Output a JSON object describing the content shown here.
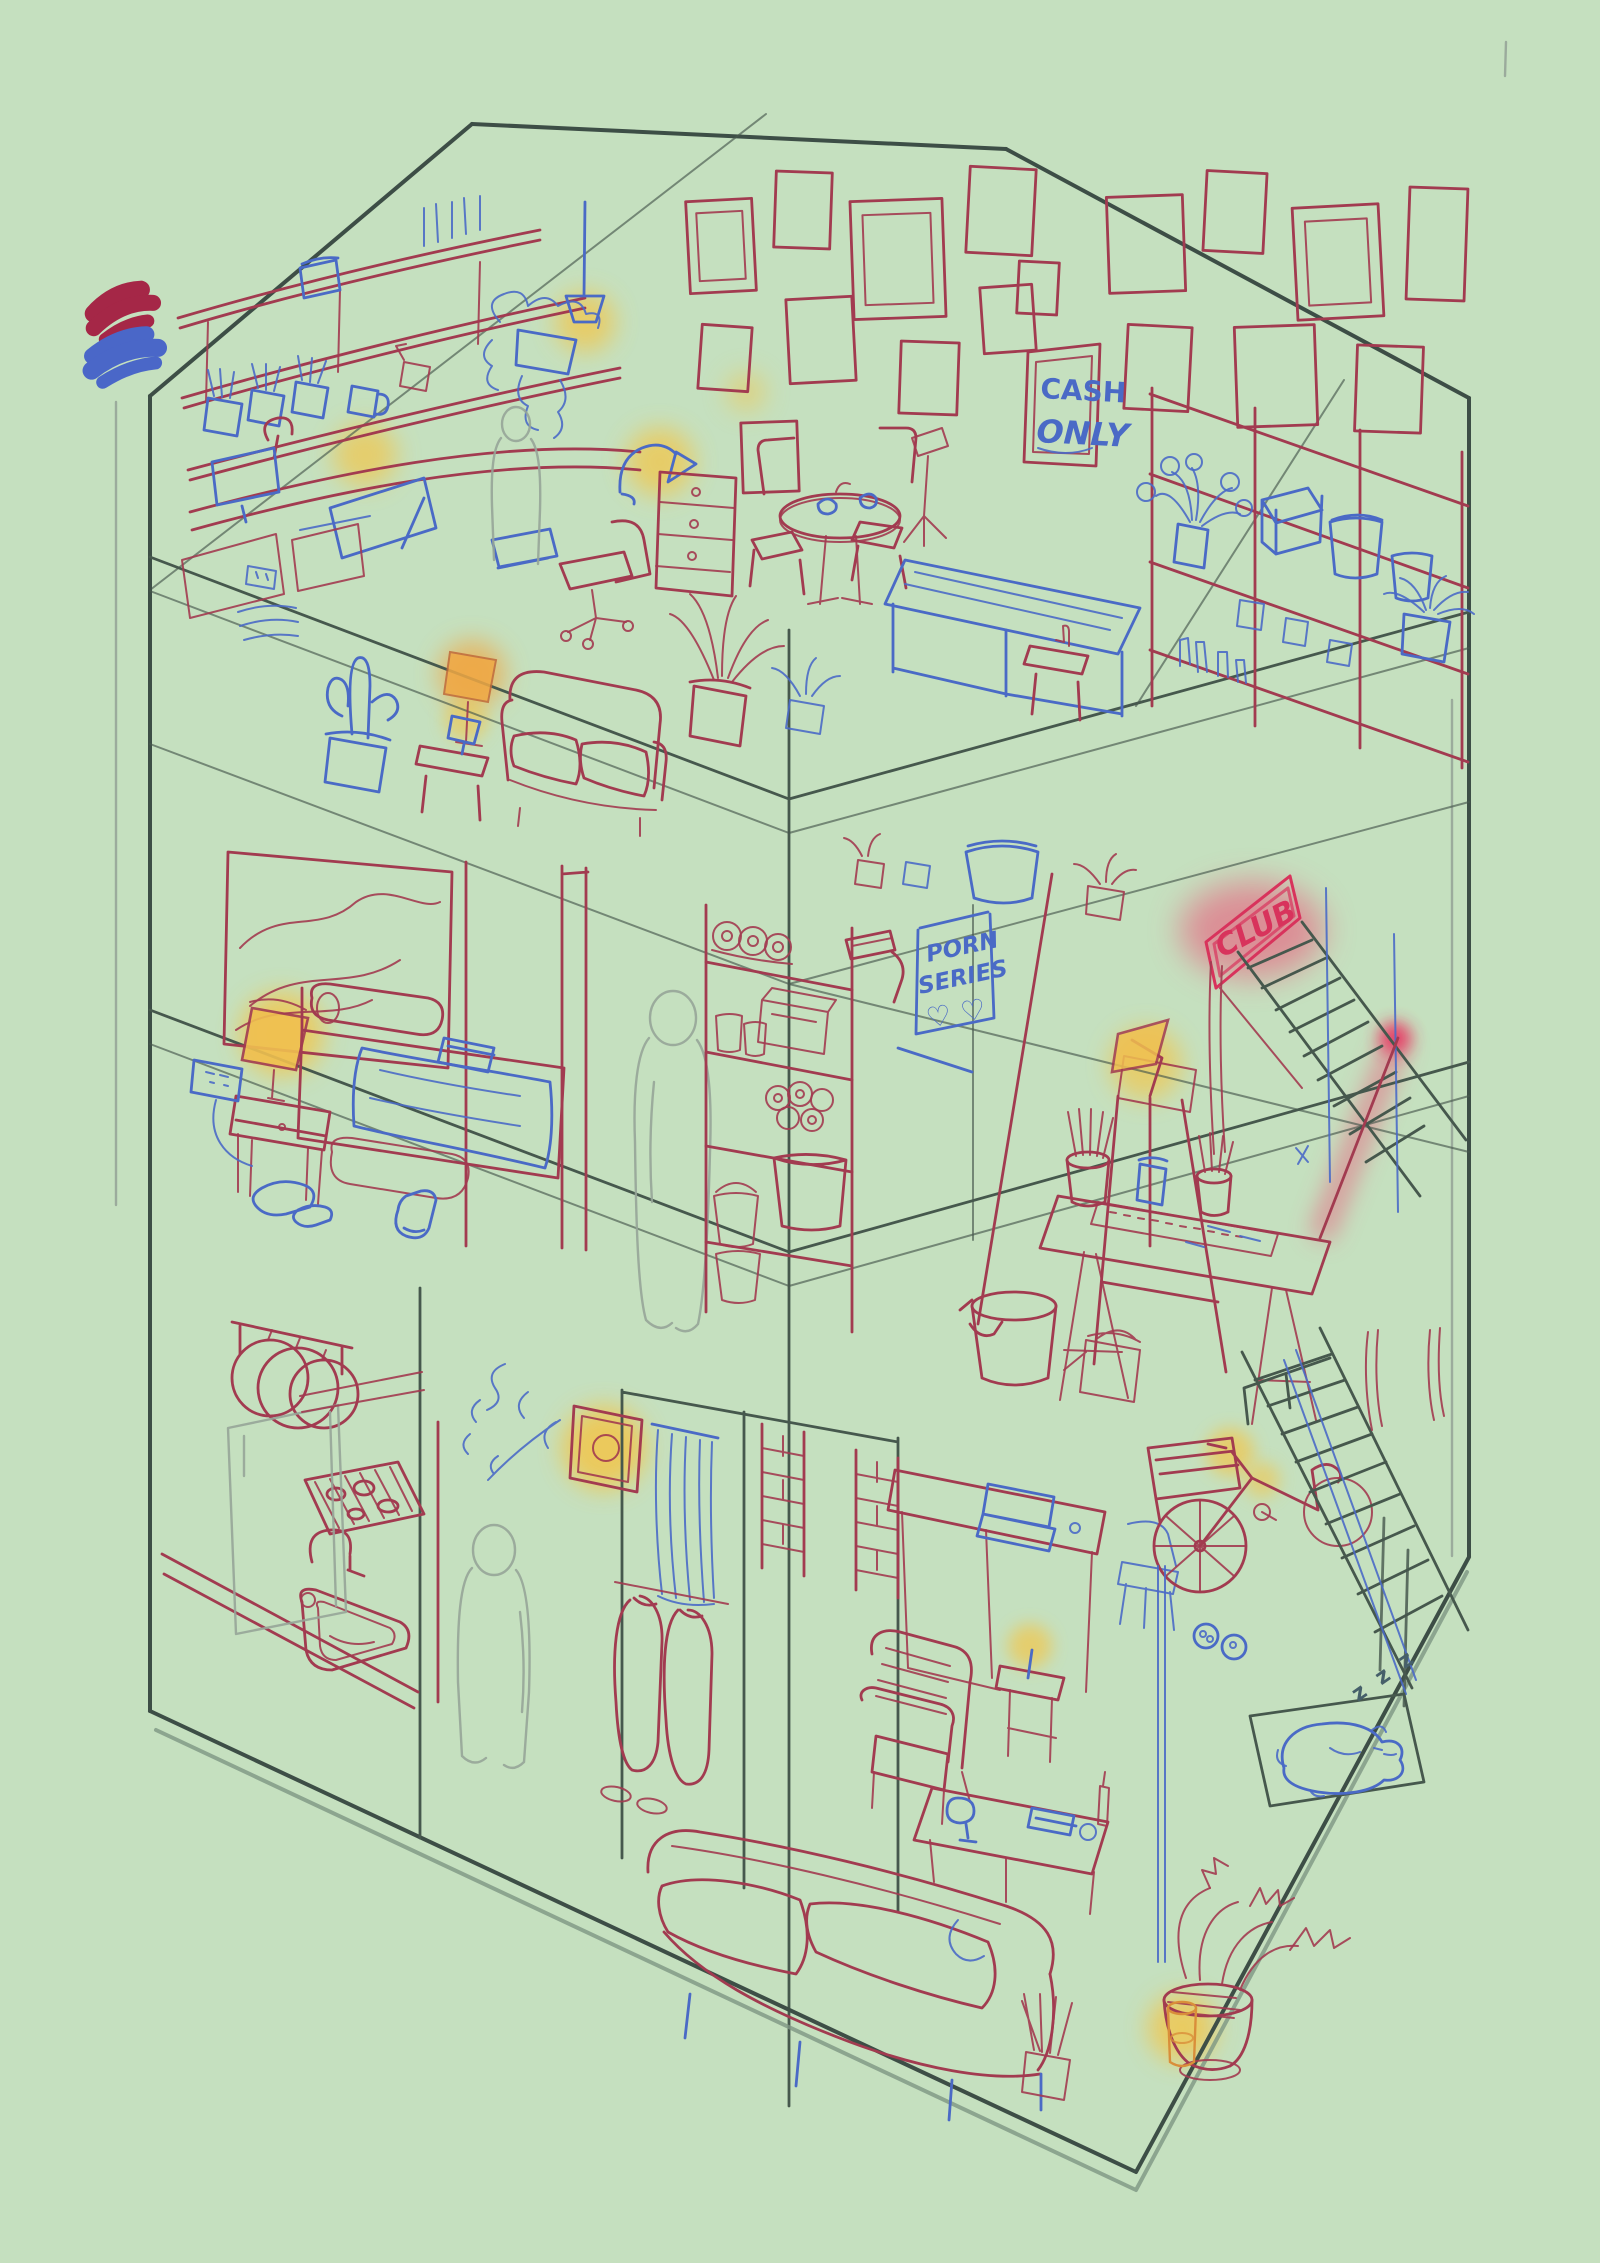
{
  "meta": {
    "title": "three-storey dollhouse cutaway — work-in-progress digital sketch",
    "canvas": {
      "width": 1600,
      "height": 2263,
      "background": "#c5e0bf"
    }
  },
  "palette": {
    "background": "#c5e0bf",
    "ink_red": "#a23b50",
    "ink_blue": "#4a6ac6",
    "ink_dark": "#3d4e46",
    "ink_faint": "#96a598",
    "glow_yellow": "#f2c64b",
    "glow_orange": "#eda23e",
    "glow_pink": "#ee4d74",
    "neon_red": "#d8335c"
  },
  "swatches": [
    {
      "name": "red paint swatch",
      "color": "#a52747"
    },
    {
      "name": "blue paint swatch",
      "color": "#4a67c8"
    }
  ],
  "texts": {
    "cash_sign": [
      "CASH",
      "ONLY"
    ],
    "poster": [
      "PORN",
      "SERIES",
      "♡ ♡"
    ],
    "neon_sign": "CLUB",
    "sleep": "z z z"
  },
  "floors": [
    {
      "id": "attic-studio",
      "label": "Top floor — studio and lounge",
      "items": [
        "wall of picture frames",
        "CASH ONLY framed sign",
        "wall shelves with jar, books, hanging plant and brush cups",
        "drawing desk with monitor, board and lamp",
        "office chair",
        "printer",
        "drawer unit",
        "pendant lamp",
        "round table with chairs and mugs",
        "music stand",
        "red sofa",
        "orange floor lamp",
        "blue cactus pot",
        "side table with blue lamp",
        "potted plants",
        "blue work table",
        "bar shelving with flowers, box, canisters and pots",
        "ghost figure sketch"
      ]
    },
    {
      "id": "middle-floor",
      "label": "Middle floor — bedroom, storage and atelier",
      "items": [
        "mountain painting",
        "glowing nightstand lamp",
        "wall outlet with cord",
        "bed with rolled pillow and blue blanket",
        "rug",
        "shoes and sock on floor",
        "ghost figure sketch",
        "storage shelf with paper rolls, boxes, cans, pastries, jar and buckets",
        "paint roller",
        "PORN SERIES poster with hearts",
        "leaning mop and bucket",
        "watering can",
        "easel with clamp lamp",
        "drafting table with brush cups, keyboard and tubes",
        "neon CLUB sign with pink glow",
        "staircase with glowing handrail"
      ]
    },
    {
      "id": "ground-floor",
      "label": "Ground floor — kitchen and living room",
      "items": [
        "hanging pans",
        "gas cooktop",
        "sink with faucet",
        "fridge sketch",
        "ghost figure sketch",
        "glowing wall sconce with vine",
        "blue curtain",
        "hanging coats and shoes",
        "brick door frames",
        "desk with laptop",
        "blue chair",
        "red armchair",
        "candle side table",
        "coffee table with wine glass, book, cup and bottle",
        "red couch with blue legs",
        "bicycle with crate and glowing headlight",
        "dark staircase",
        "dog bed with sleeping blue dog",
        "food bowls",
        "potted plants with glowing candle"
      ]
    }
  ],
  "figures": {
    "count": 3,
    "style": "faint grey ghost silhouettes"
  }
}
